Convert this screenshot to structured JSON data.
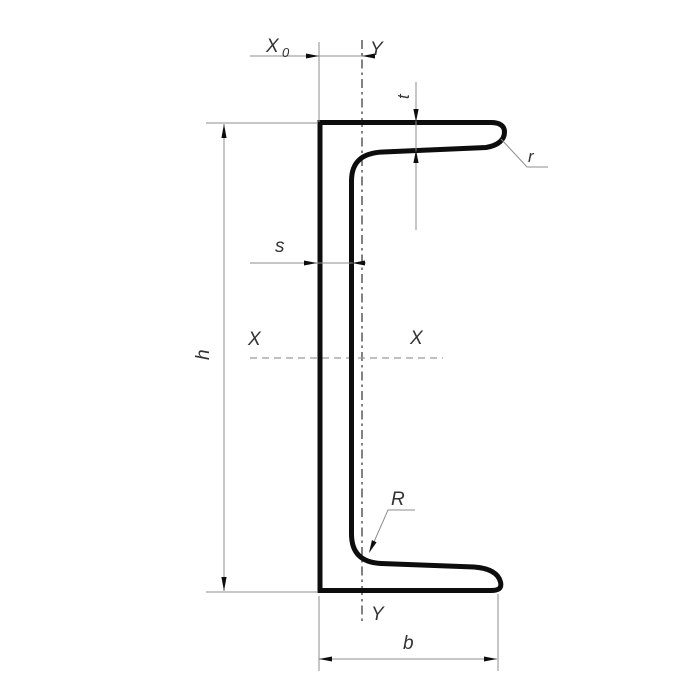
{
  "figure": {
    "type": "technical-drawing",
    "subject": "channel-section-cross-section",
    "labels": {
      "centroid_offset_main": "X",
      "centroid_offset_sub": "0",
      "y_axis_top": "Y",
      "y_axis_bottom": "Y",
      "x_axis_left": "X",
      "x_axis_right": "X",
      "flange_thickness": "t",
      "flange_tip_radius": "r",
      "web_thickness": "s",
      "section_height": "h",
      "inner_corner_radius": "R",
      "flange_width": "b"
    },
    "colors": {
      "outline": "#0d0d0d",
      "thin_line": "#8c8c8c",
      "centerline": "#3f3f3f",
      "dashed_axis": "#9a9a9a",
      "label_text": "#333333",
      "background": "#ffffff"
    }
  }
}
